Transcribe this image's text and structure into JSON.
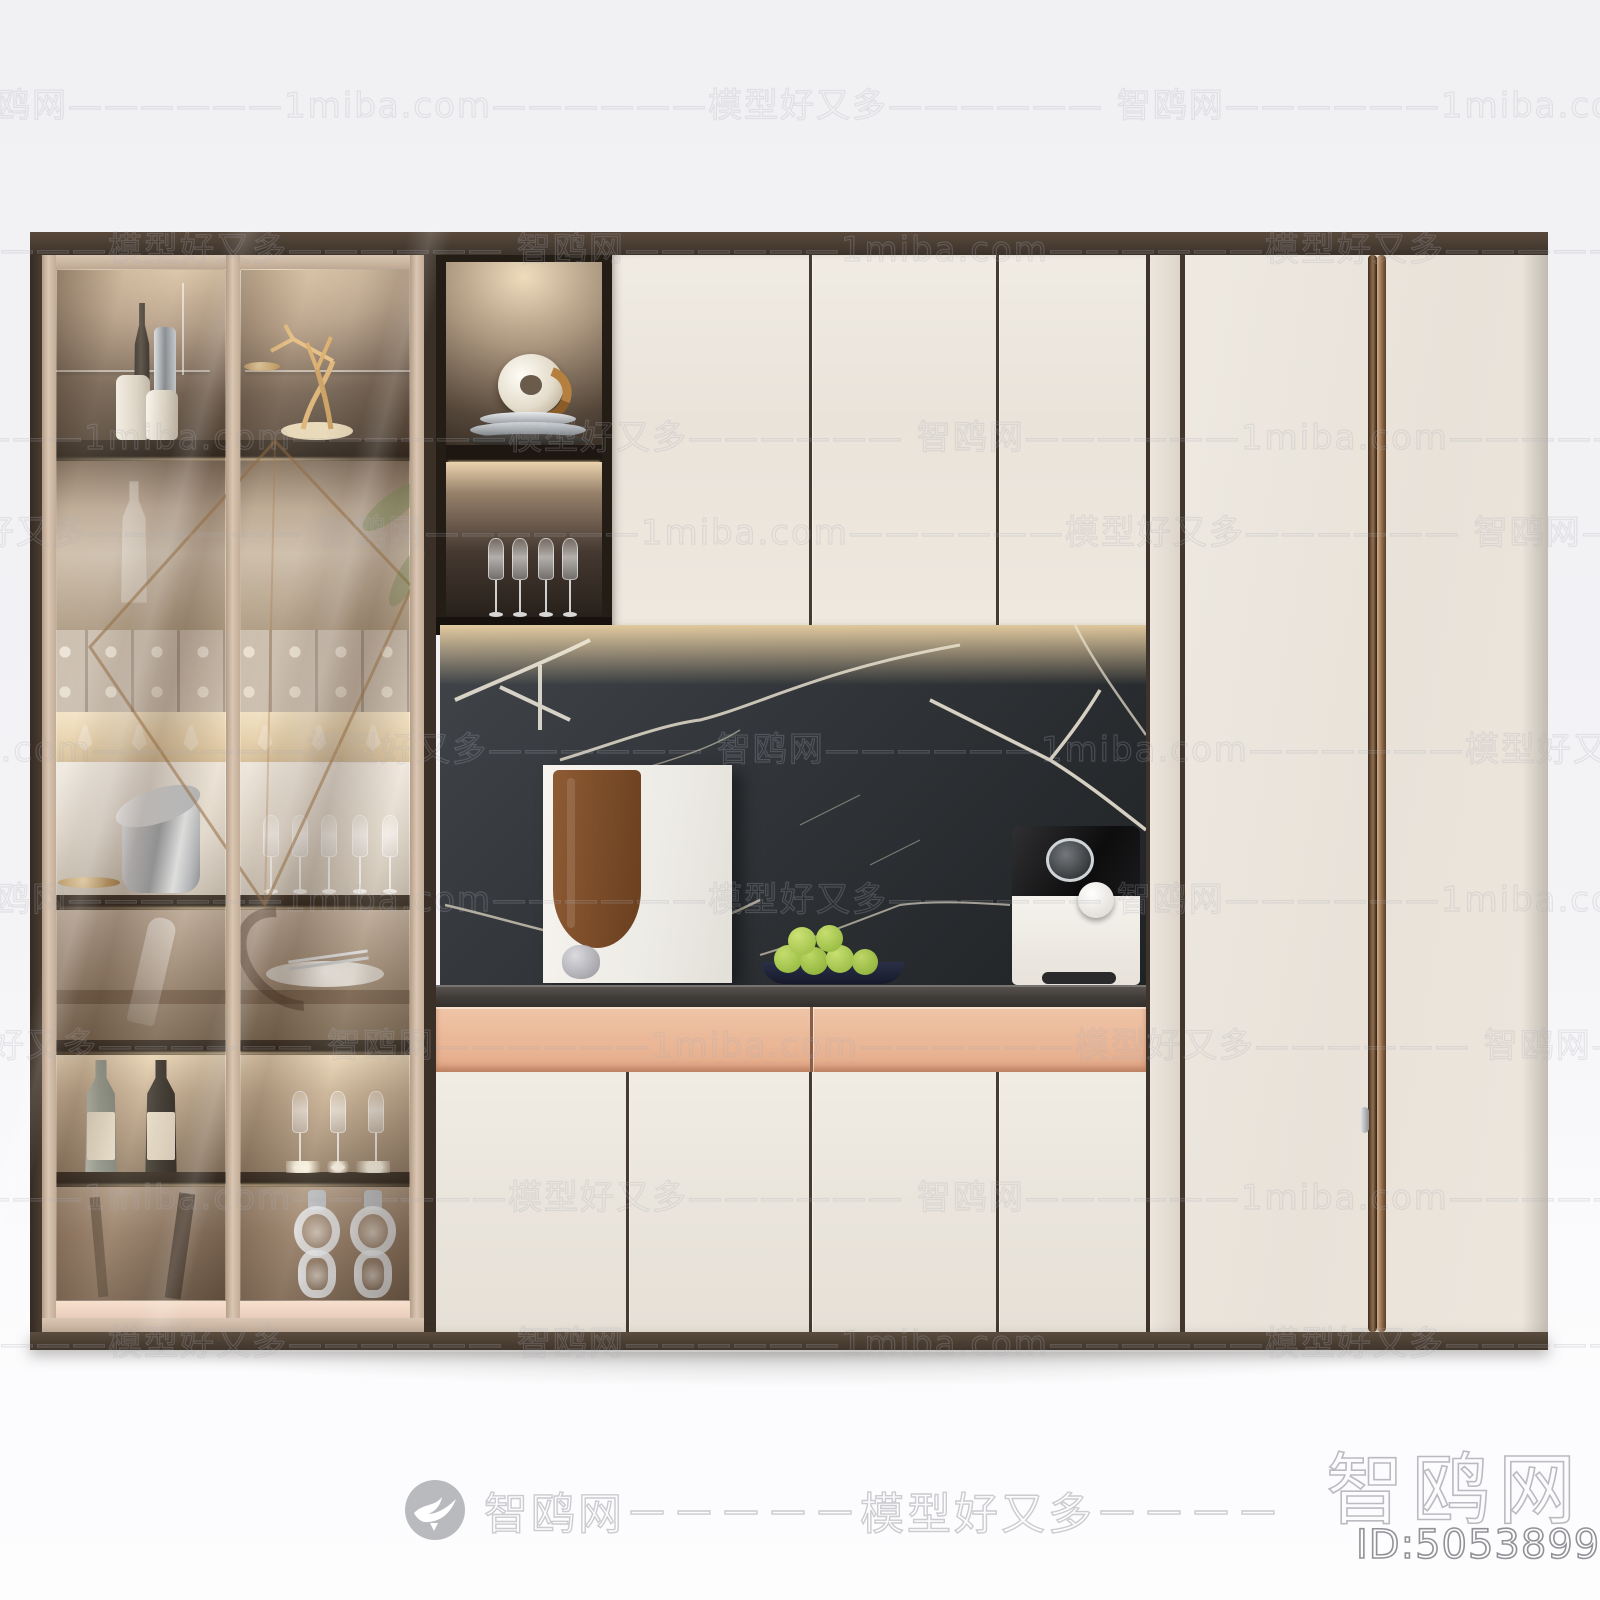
{
  "watermark": {
    "tile_text": "智鸥网——————1miba.com——————模型好又多——————",
    "rows": [
      {
        "y": 78,
        "x": -40
      },
      {
        "y": 222,
        "x": -640
      },
      {
        "y": 410,
        "x": -240
      },
      {
        "y": 505,
        "x": -840
      },
      {
        "y": 722,
        "x": -440
      },
      {
        "y": 872,
        "x": -40
      },
      {
        "y": 1018,
        "x": -830
      },
      {
        "y": 1170,
        "x": -240
      },
      {
        "y": 1316,
        "x": -640
      }
    ],
    "footer_text": "智鸥网－－－－－模型好又多－－－－",
    "corner_brand": "智鸥网",
    "corner_id": "ID:505389933"
  },
  "scene": {
    "subject": "modern wine display cabinet wall unit",
    "colors": {
      "door_cream": "#eae4db",
      "drawer_blush": "#e9b79c",
      "marble_dark": "#33373b",
      "marble_vein": "#efe8d8",
      "frame_espresso": "#453a30",
      "glass_frame_champagne": "#d6c3b0",
      "handle_bronze": "#8a6547",
      "fruit_green": "#9cc23f",
      "background_wall": "#f2f2f5"
    }
  }
}
